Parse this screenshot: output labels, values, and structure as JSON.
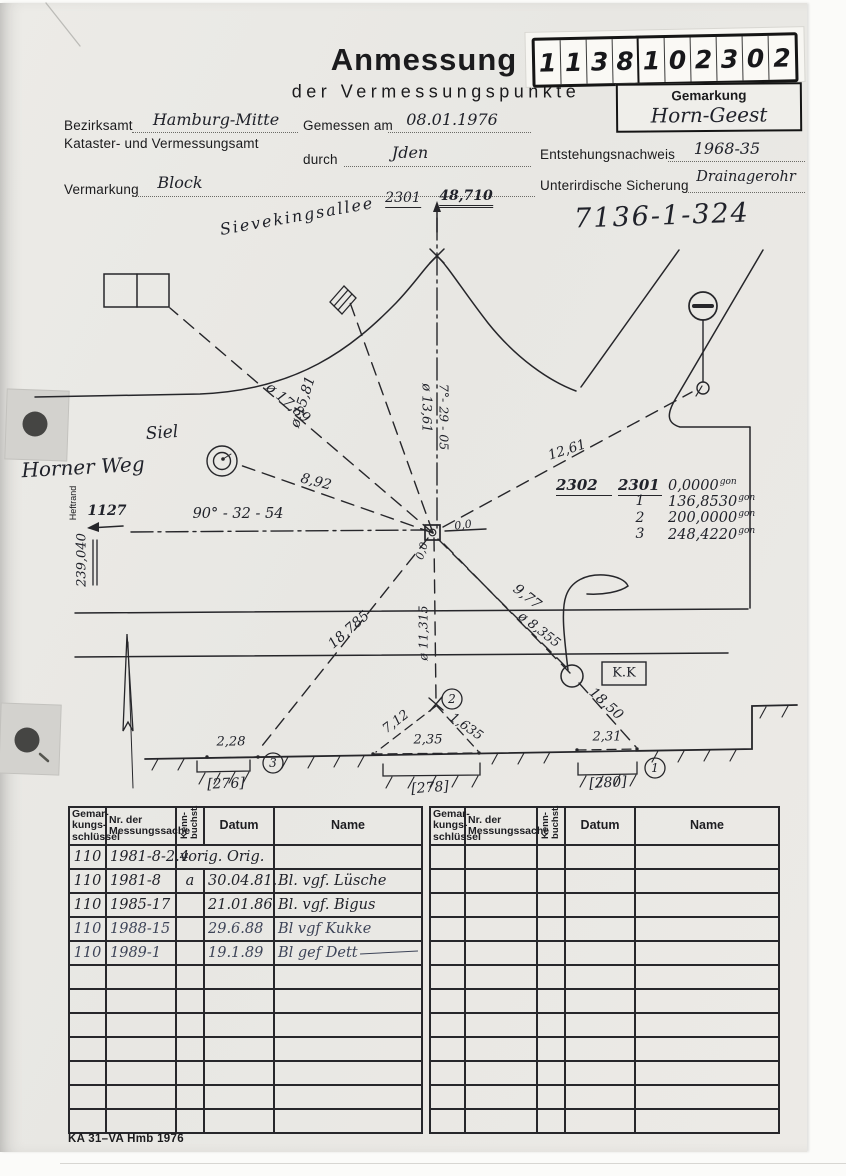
{
  "header": {
    "title": "Anmessung",
    "subtitle": "der Vermessungspunkte",
    "stamp_digits": [
      "1",
      "1",
      "3",
      "8",
      "1",
      "0",
      "2",
      "3",
      "0",
      "2"
    ],
    "gemarkung_label": "Gemarkung",
    "gemarkung_value": "Horn-Geest"
  },
  "form": {
    "bezirksamt_label": "Bezirksamt",
    "bezirksamt_value": "Hamburg-Mitte",
    "amt_line": "Kataster- und Vermessungsamt",
    "gemessen_label": "Gemessen am",
    "gemessen_value": "08.01.1976",
    "durch_label": "durch",
    "durch_value": "Jden",
    "entstehung_label": "Entstehungsnachweis",
    "entstehung_value": "1968-35",
    "vermarkung_label": "Vermarkung",
    "vermarkung_value": "Block",
    "sicherung_label": "Unterirdische Sicherung",
    "sicherung_value": "Drainagerohr",
    "point_number": "7136-1-324"
  },
  "sketch": {
    "street_top": "Sievekingsallee",
    "street_left": "Horner Weg",
    "siel_label": "Siel",
    "heftrand": "Heftrand",
    "point_top": "2301",
    "height_top": "48,710",
    "dist_17": "ø 17,89",
    "dist_15": "ø 15,81",
    "dist_13": "ø 13,61",
    "bearing_top": "7°- 29 - 05",
    "dist_12": "12,61",
    "dist_8": "8,92",
    "bearing_left": "90° - 32 - 54",
    "ref_1127": "1127",
    "coord_239": "239,040",
    "zero_right": "0,0",
    "zero_below": "0,0",
    "dist_18785": "18,785",
    "dist_11315": "ø 11,315",
    "dist_977": "9,77",
    "dist_8355": "ø 8,355",
    "dist_1850": "18,50",
    "kk_label": "K.K",
    "span_228": "2,28",
    "span_712": "7,12",
    "span_1635": "1,635",
    "span_235": "2,35",
    "span_231": "2,31",
    "bracket_276": "[276]",
    "bracket_278": "[278]",
    "bracket_280": "[280]",
    "pt1": "1",
    "pt2": "2",
    "pt3": "3",
    "angles": {
      "h1": "2302",
      "h2": "2301",
      "unit": "gon",
      "rows": [
        {
          "pt": "",
          "v": "0,0000"
        },
        {
          "pt": "1",
          "v": "136,8530"
        },
        {
          "pt": "2",
          "v": "200,0000"
        },
        {
          "pt": "3",
          "v": "248,4220"
        }
      ]
    }
  },
  "records": {
    "headers": {
      "gem": "Gemar-\nkungs-\nschlüssel",
      "nr": "Nr. der\nMessungssache",
      "kenn": "Kenn-\nbuchst.",
      "datum": "Datum",
      "name": "Name"
    },
    "rows": [
      {
        "gem": "110",
        "nr": "1981-8-2.4",
        "kenn": "",
        "datum": "vorig. Orig.",
        "name": ""
      },
      {
        "gem": "110",
        "nr": "1981-8",
        "kenn": "a",
        "datum": "30.04.81.",
        "name": "Bl. vgf. Lüsche"
      },
      {
        "gem": "110",
        "nr": "1985-17",
        "kenn": "",
        "datum": "21.01.86",
        "name": "Bl. vgf. Bigus"
      },
      {
        "gem": "110",
        "nr": "1988-15",
        "kenn": "",
        "datum": "29.6.88",
        "name": "Bl vgf Kukke"
      },
      {
        "gem": "110",
        "nr": "1989-1",
        "kenn": "",
        "datum": "19.1.89",
        "name": "Bl gef Dett"
      }
    ]
  },
  "footer": {
    "form_id": "KA 31–VA Hmb 1976"
  }
}
